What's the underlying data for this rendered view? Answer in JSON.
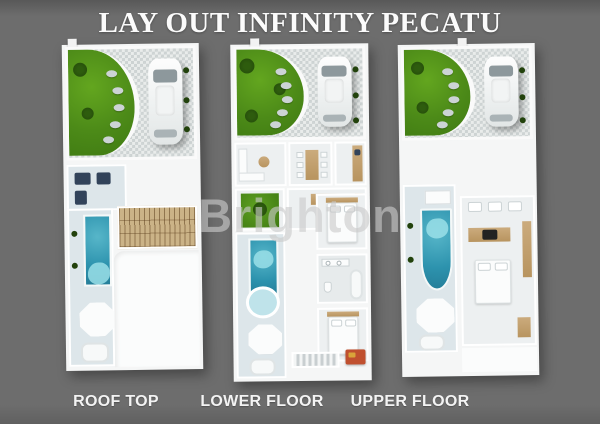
{
  "title": "LAY OUT INFINITY PECATU",
  "watermark": "Brighton",
  "plans": [
    {
      "id": "roof-top",
      "label": "ROOF TOP"
    },
    {
      "id": "lower-floor",
      "label": "LOWER FLOOR"
    },
    {
      "id": "upper-floor",
      "label": "UPPER FLOOR"
    }
  ],
  "colors": {
    "background": "#6d6d6d",
    "title_text": "#fbfbfb",
    "label_text": "#f3f3f3",
    "watermark": "#c9c9c9",
    "plan_base": "#f5f6f6",
    "pool": "#2d93ae",
    "garden": "#4c8a18",
    "paving": "#e9eceb",
    "wood": "#c3a273",
    "accent_orange": "#c0502f"
  }
}
